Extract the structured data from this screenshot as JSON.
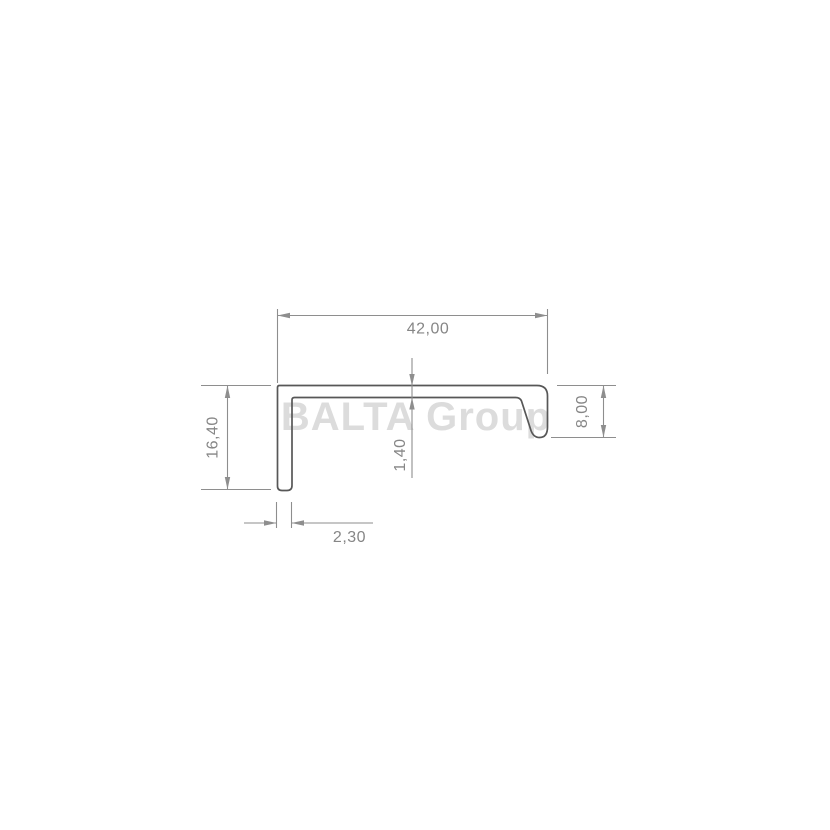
{
  "watermark": {
    "text": "BALTA Group"
  },
  "colors": {
    "background": "#ffffff",
    "profile_line": "#575757",
    "dimension_line": "#8e8e8e",
    "dimension_text": "#868686",
    "watermark_text": "#dcdcdc"
  },
  "dimensions": {
    "width_top": {
      "label": "42,00"
    },
    "height_left": {
      "label": "16,40"
    },
    "height_right": {
      "label": "8,00"
    },
    "thickness_top": {
      "label": "1,40"
    },
    "thickness_leg_bottom": {
      "label": "2,30"
    }
  }
}
